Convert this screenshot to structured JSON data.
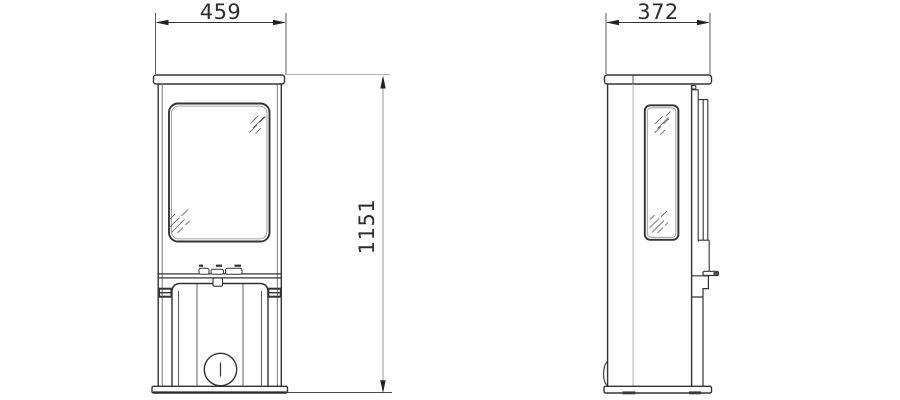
{
  "drawing": {
    "title": "stove-technical-dimension-drawing",
    "views": {
      "front": "front-view",
      "side": "side-view"
    },
    "dimensions": {
      "front_width_mm": "459",
      "height_mm": "1151",
      "side_depth_mm": "372"
    },
    "colors": {
      "main_line": "#333333",
      "secondary_line": "#6b6b6b",
      "dimension_line_gray": "#ababab",
      "arrow": "#222222",
      "background": "#ffffff"
    }
  }
}
